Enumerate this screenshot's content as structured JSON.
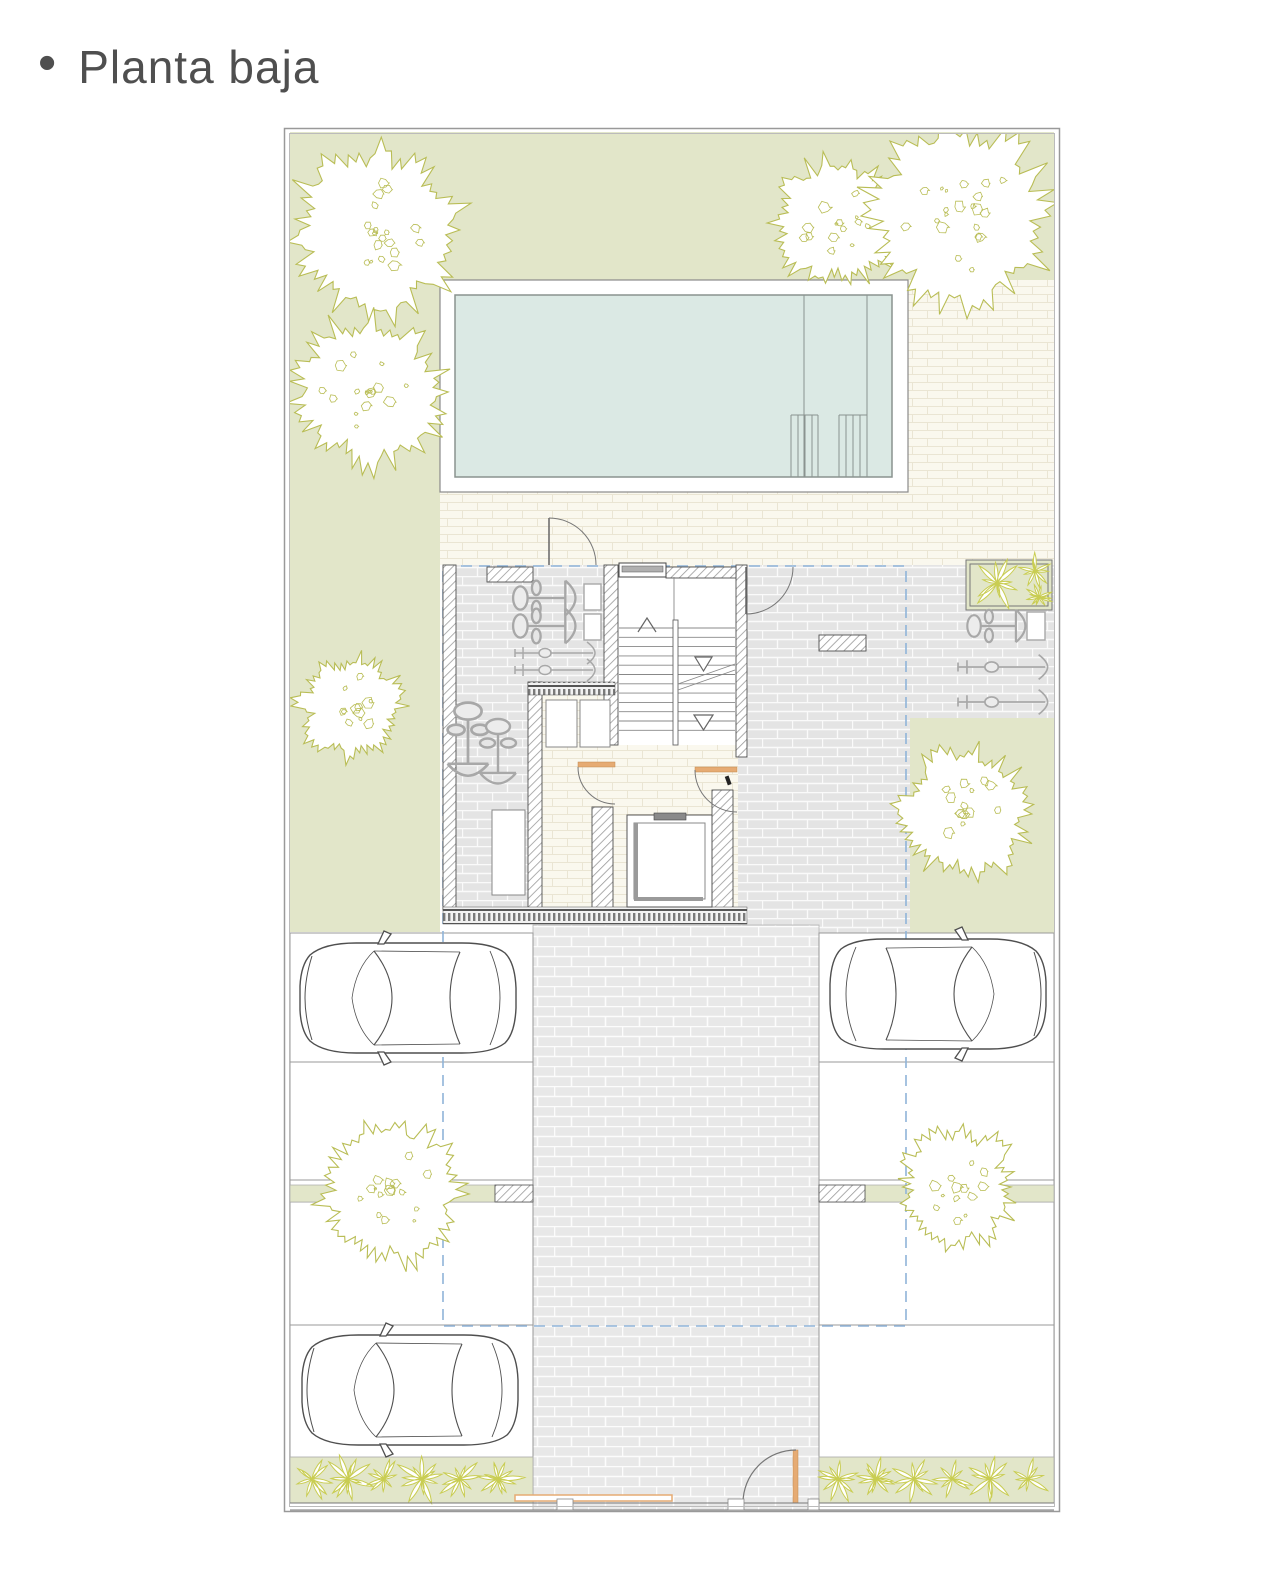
{
  "title": {
    "bullet": "•",
    "text": "Planta baja"
  },
  "colors": {
    "title": "#4f4f4f",
    "garden": "#e2e6c9",
    "tree": "#b9bd55",
    "plant": "#c9cd52",
    "water": "#dbe9e4",
    "water_border": "#8a938f",
    "cream": "#faf8ee",
    "cream_joint": "#eae5d3",
    "gray": "#e4e4e4",
    "gray_joint": "#fafafa",
    "drive": "#e8e8e8",
    "drive_joint": "#fcfcfc",
    "hatch": "#9a9a9a",
    "wall": "#4f4f4f",
    "dash": "#8fb4d9",
    "doorframe": "#e6ab73",
    "car": "#4f4f4f",
    "equip": "#a8a8a8",
    "stall": "#999999"
  }
}
